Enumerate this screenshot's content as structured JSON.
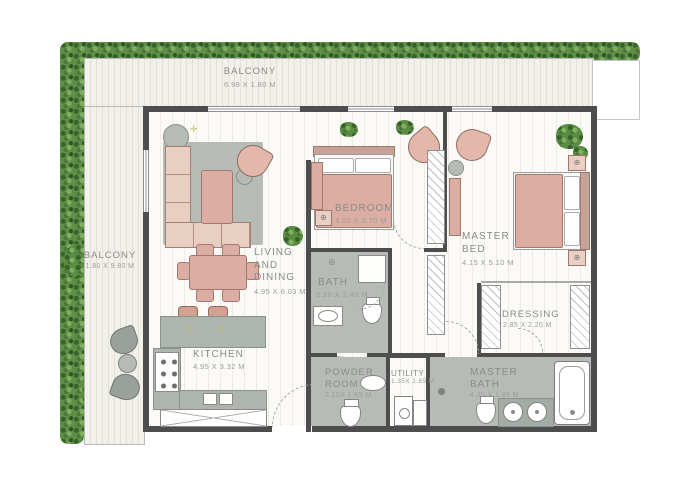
{
  "rooms": {
    "balcony_top": {
      "name": "BALCONY",
      "dims": "6.98 X 1.80 M"
    },
    "balcony_left": {
      "name": "BALCONY",
      "dims": "1.80 X 9.80 M"
    },
    "living_dining": {
      "name": "LIVING AND DINING",
      "dims": "4.95 X 6.03 M"
    },
    "bedroom": {
      "name": "BEDROOM",
      "dims": "4.00 X 3.70 M"
    },
    "master_bed": {
      "name": "MASTER BED",
      "dims": "4.15 X 5.10 M"
    },
    "bath": {
      "name": "BATH",
      "dims": "2.20 X 2.40 M"
    },
    "dressing": {
      "name": "DRESSING",
      "dims": "2.85 X 2.20 M"
    },
    "kitchen": {
      "name": "KITCHEN",
      "dims": "4.95 X 3.32 M"
    },
    "powder_room": {
      "name": "POWDER ROOM",
      "dims": "2.10X 1.85 M"
    },
    "utility": {
      "name": "UTILITY",
      "dims": "1.35X 1.85 M"
    },
    "master_bath": {
      "name": "MASTER BATH",
      "dims": "4.35 X 1.85 M"
    }
  },
  "icons": {
    "ceiling_light": "⊕",
    "sparkle": "✛"
  },
  "colors": {
    "wall": "#4d4d4d",
    "floor_tint": "#b6bcb5",
    "furniture_pink": "#dcaea3",
    "hedge_green": "#5f8f49",
    "label_text": "#8a8a8a"
  }
}
